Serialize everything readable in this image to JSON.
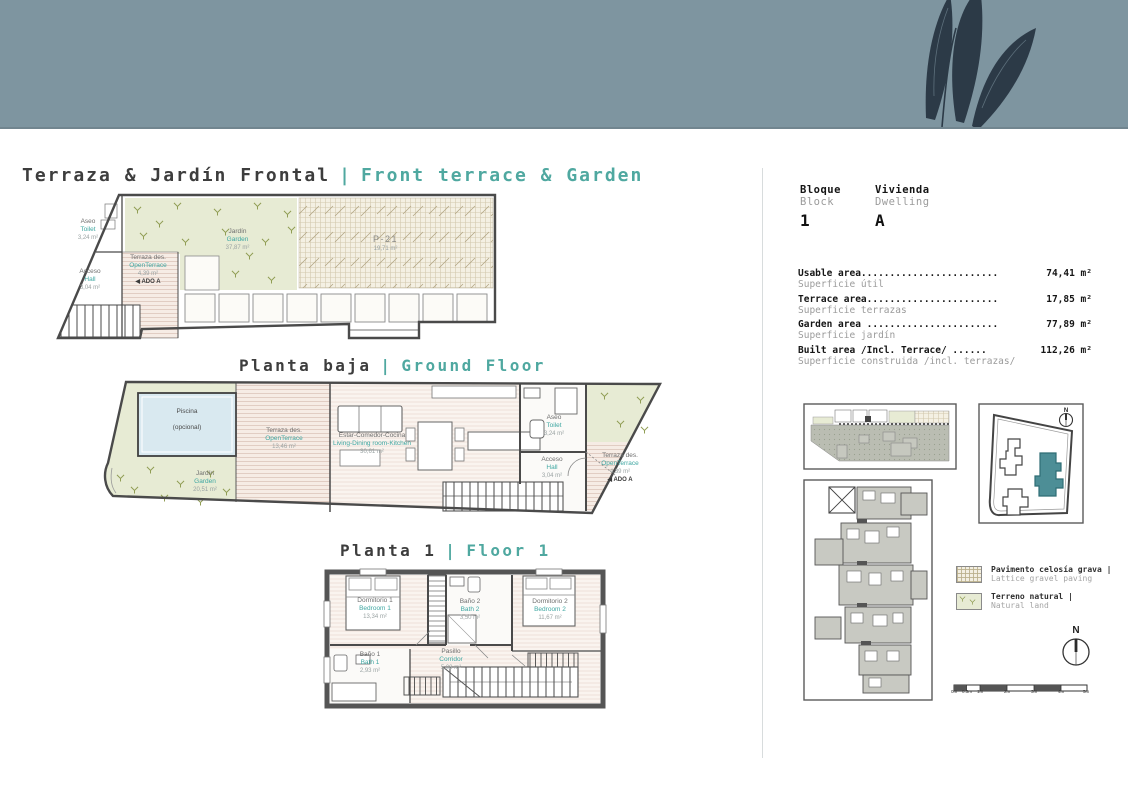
{
  "header": {
    "band_color": "#7e95a0",
    "leaf_color": "#2c3a47"
  },
  "titles": {
    "main": {
      "es": "Terraza & Jardín Frontal",
      "sep": "|",
      "en": "Front terrace & Garden"
    },
    "ground": {
      "es": "Planta baja",
      "sep": "|",
      "en": "Ground Floor"
    },
    "floor1": {
      "es": "Planta 1",
      "sep": "|",
      "en": "Floor 1"
    }
  },
  "unit": {
    "bloque": {
      "es": "Bloque",
      "en": "Block",
      "value": "1"
    },
    "vivienda": {
      "es": "Vivienda",
      "en": "Dwelling",
      "value": "A"
    }
  },
  "areas": {
    "rows": [
      {
        "label": "Usable area........................",
        "value": "74,41 m²",
        "sub": "Superficie útil"
      },
      {
        "label": "Terrace area.......................",
        "value": "17,85 m²",
        "sub": "Superficie terrazas"
      },
      {
        "label": "Garden area .......................",
        "value": "77,89 m²",
        "sub": "Superficie jardín"
      },
      {
        "label": "Built area /Incl. Terrace/ ......",
        "value": "112,26 m²",
        "sub": "Superficie construida /incl. terrazas/"
      }
    ]
  },
  "plan_terrace": {
    "garden": {
      "es": "Jardín",
      "en": "Garden",
      "area": "37,87 m²"
    },
    "parking": {
      "name": "P-21",
      "area": "19,71 m²"
    },
    "open_terrace": {
      "es": "Terraza des.",
      "en": "OpenTerrace",
      "area": "4,39 m²",
      "note": "◀ ADO A"
    },
    "hall": {
      "es": "Acceso",
      "en": "Hall",
      "area": "3,04 m²"
    },
    "toilet": {
      "es": "Aseo",
      "en": "Toilet",
      "area": "3,24 m²"
    }
  },
  "plan_ground": {
    "pool": {
      "line1": "Piscina",
      "line2": "(opcional)"
    },
    "garden": {
      "es": "Jardín",
      "en": "Garden",
      "area": "20,51 m²"
    },
    "open_terrace": {
      "es": "Terraza des.",
      "en": "OpenTerrace",
      "area": "13,46 m²"
    },
    "living": {
      "es": "Estar-Comedor-Cocina",
      "en": "Living-Dining room-Kitchen",
      "area": "30,61 m²"
    },
    "toilet": {
      "es": "Aseo",
      "en": "Toilet",
      "area": "3,24 m²"
    },
    "hall": {
      "es": "Acceso",
      "en": "Hall",
      "area": "3,04 m²"
    },
    "open_terrace_side": {
      "es": "Terraza des.",
      "en": "OpenTerrace",
      "area": "4,39 m²",
      "note": "◀ ADO A"
    }
  },
  "plan_floor1": {
    "bedroom1": {
      "es": "Dormitorio 1",
      "en": "Bedroom 1",
      "area": "13,34 m²"
    },
    "bath2": {
      "es": "Baño 2",
      "en": "Bath 2",
      "area": "3,50 m²"
    },
    "bedroom2": {
      "es": "Dormitorio 2",
      "en": "Bedroom 2",
      "area": "11,67 m²"
    },
    "bath1": {
      "es": "Baño 1",
      "en": "Bath 1",
      "area": "2,93 m²"
    },
    "corridor": {
      "es": "Pasillo",
      "en": "Corridor",
      "area": "5,08 m²"
    }
  },
  "legend": {
    "items": [
      {
        "es": "Pavimento celosía grava |",
        "en": "Lattice gravel paving"
      },
      {
        "es": "Terreno natural |",
        "en": "Natural land"
      }
    ]
  },
  "compass": {
    "label": "N"
  },
  "scale": {
    "ticks": [
      "0m",
      "0.5m",
      "1m",
      "2m",
      "3m",
      "4m",
      "5m"
    ]
  }
}
